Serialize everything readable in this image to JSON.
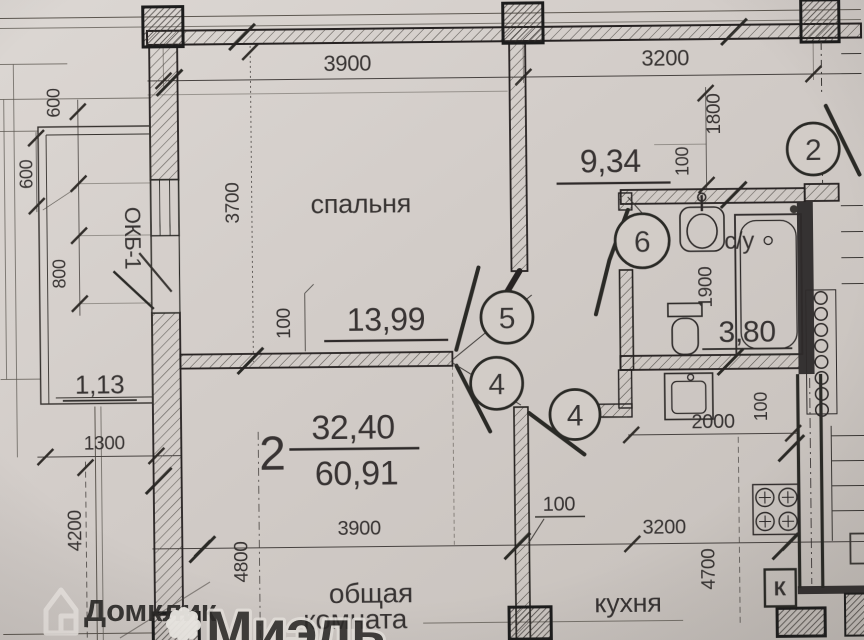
{
  "apartment": {
    "number": "2",
    "living_area": "32,40",
    "total_area": "60,91"
  },
  "rooms": {
    "bedroom": {
      "name": "спальня",
      "area": "13,99"
    },
    "hallway": {
      "area": "9,34"
    },
    "bathroom": {
      "name": "с/у",
      "area": "3,80"
    },
    "kitchen": {
      "name": "кухня"
    },
    "living": {
      "name_line1": "общая",
      "name_line2": "комната"
    },
    "balcony": {
      "area": "1,13"
    }
  },
  "axis_markers": {
    "a2": "2",
    "a6": "6",
    "a5": "5",
    "a4a": "4",
    "a4b": "4"
  },
  "labels": {
    "window_type": "ОКБ-1",
    "vent_duct": "К"
  },
  "dimensions": {
    "top_span_left": "3900",
    "top_span_right": "3200",
    "bottom_span_left": "3900",
    "bottom_span_right": "3200",
    "left_600a": "600",
    "left_600b": "600",
    "left_800": "800",
    "bedroom_height": "3700",
    "balcony_width": "1300",
    "balcony_height": "4200",
    "living_height": "4800",
    "kitchen_height": "4700",
    "hall_height": "1800",
    "hall_wall": "100",
    "bath_height": "1900",
    "kitchen_top": "2000",
    "kitchen_wall": "100",
    "interior_wall": "100",
    "partition_label": "100"
  },
  "watermark": {
    "brand_primary": "Домклик",
    "brand_secondary": "Миэль"
  }
}
